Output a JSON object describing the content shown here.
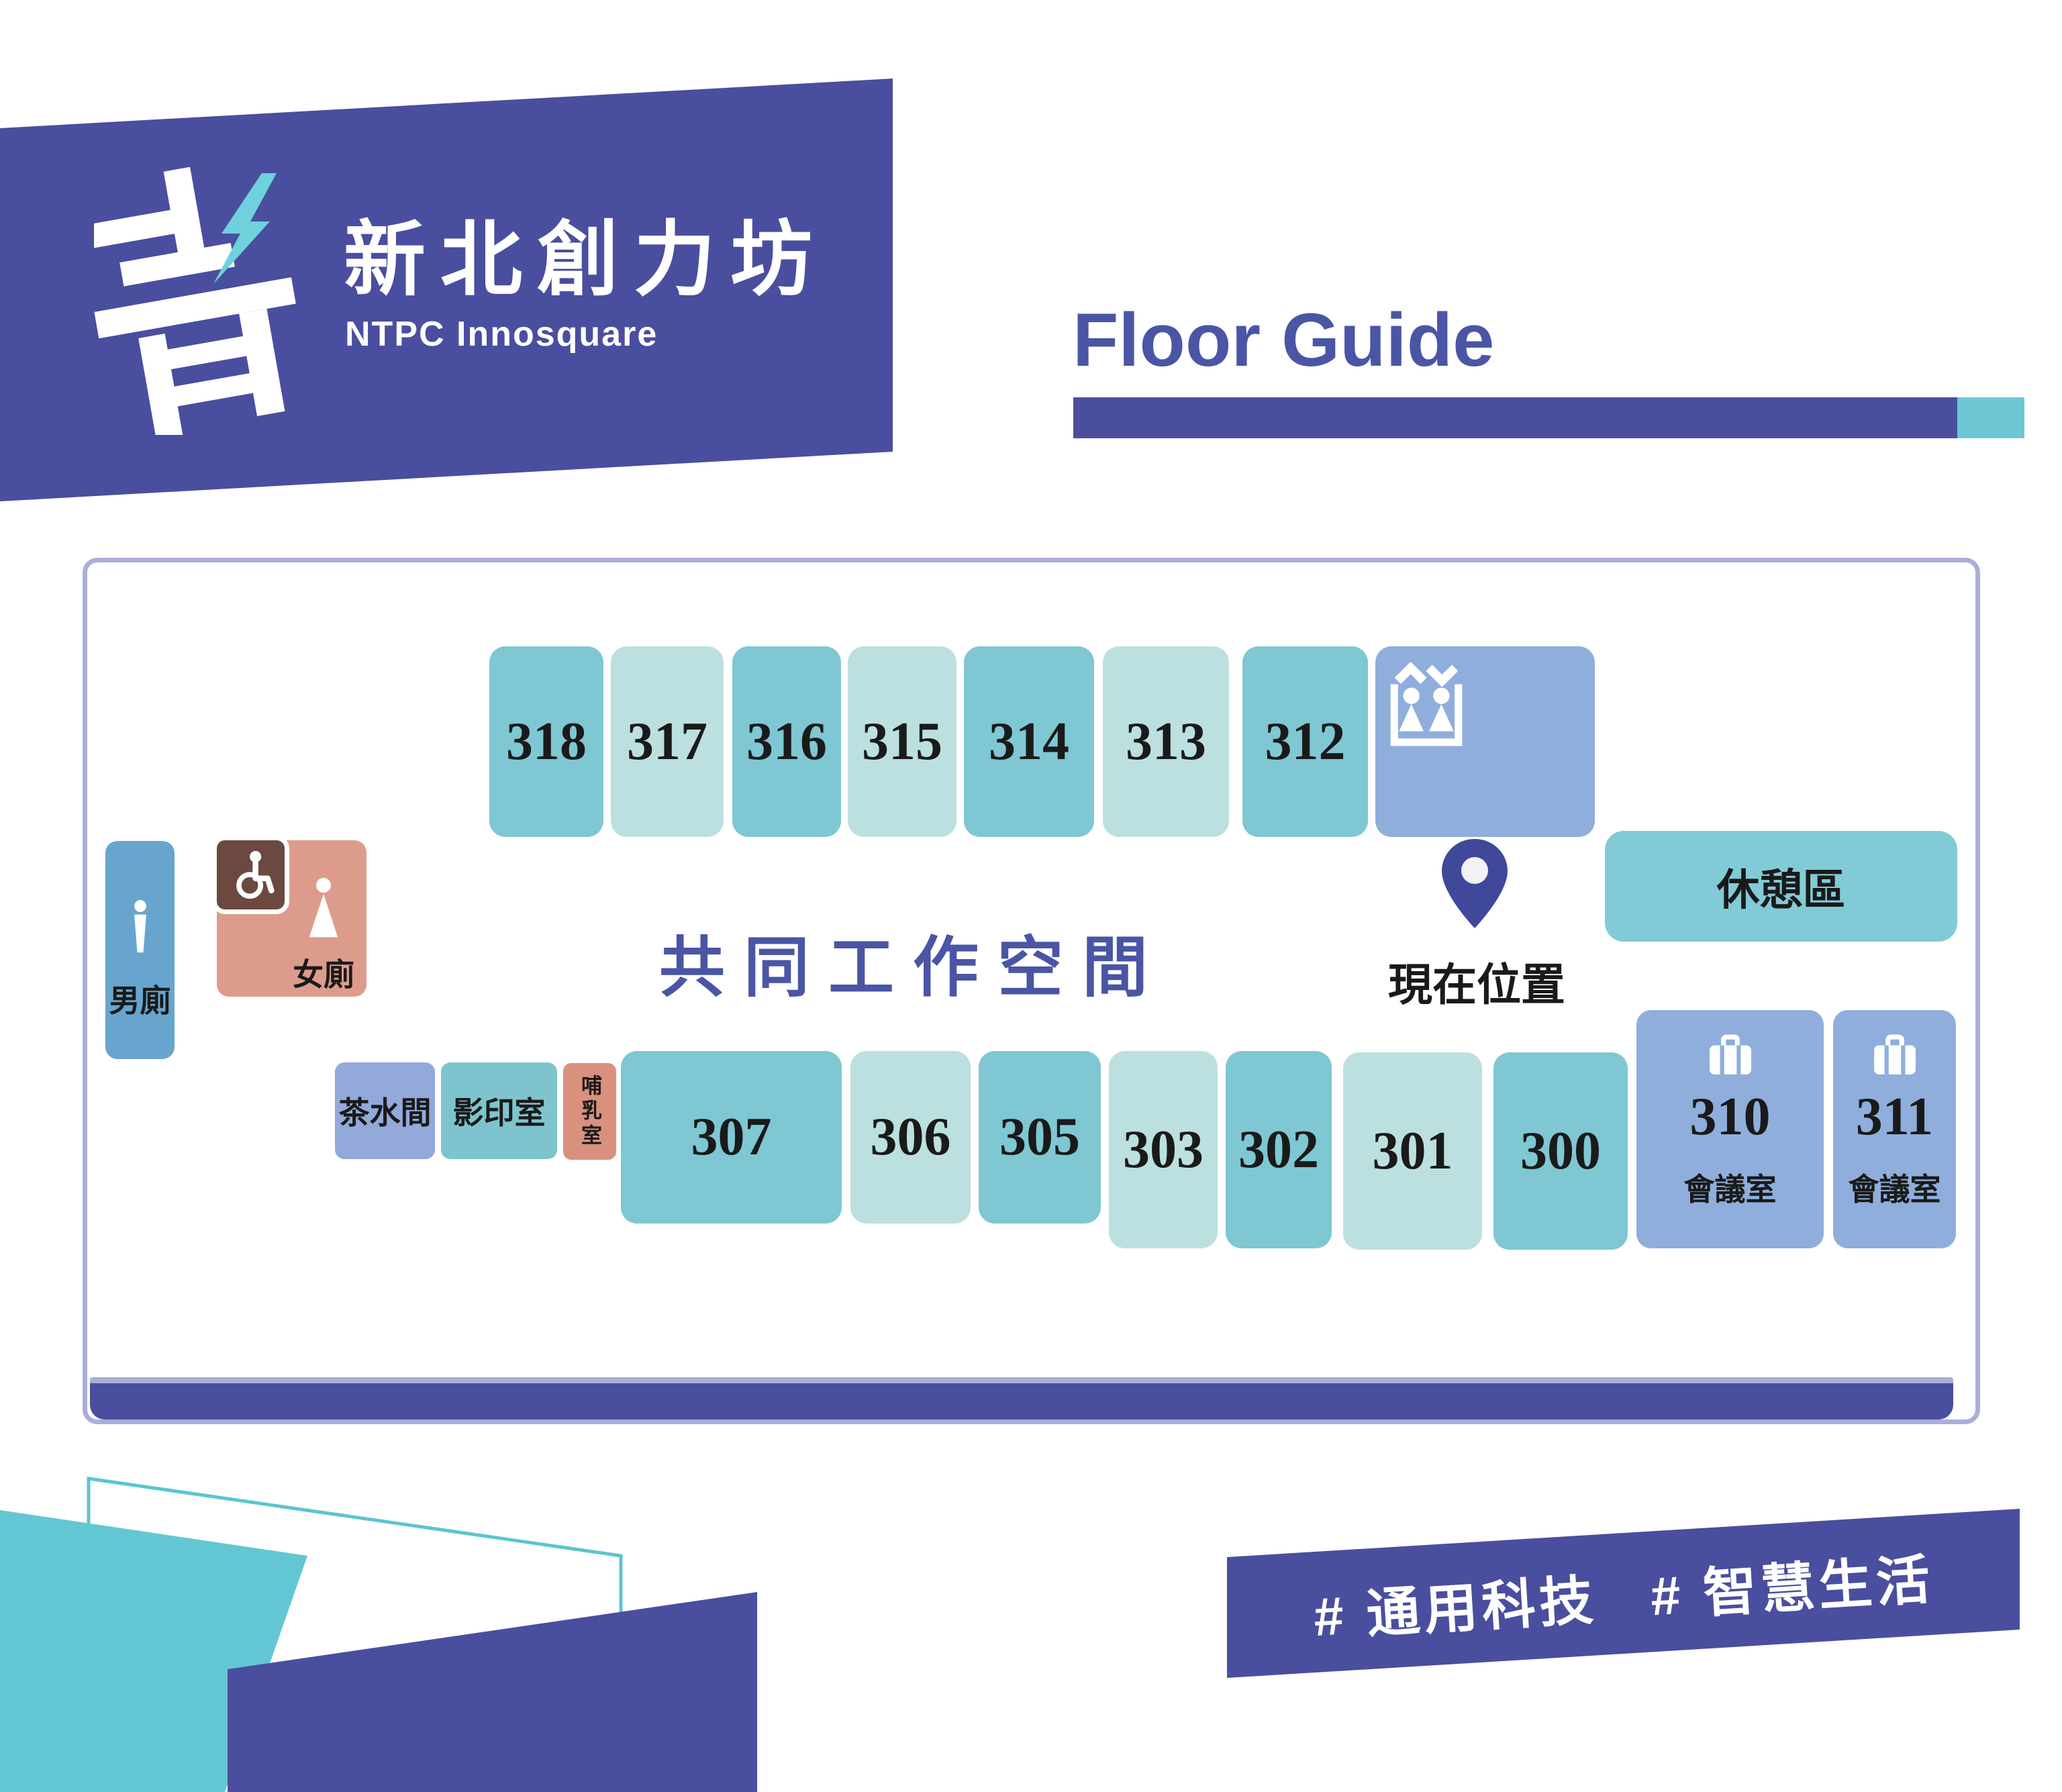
{
  "brand": {
    "title": "新北創力坊",
    "subtitle": "NTPC Innosquare",
    "logo_glyph": "青-lightning-logo"
  },
  "header": {
    "title": "Floor Guide"
  },
  "map": {
    "labels": {
      "coworking": "共同工作空間",
      "current_location": "現在位置",
      "rest_area": "休憩區",
      "male_toilet": "男廁",
      "female_toilet": "女廁",
      "tea_room": "茶水間",
      "copy_room": "影印室",
      "nursing_room": "哺乳室"
    },
    "top_rooms": [
      {
        "number": "318"
      },
      {
        "number": "317"
      },
      {
        "number": "316"
      },
      {
        "number": "315"
      },
      {
        "number": "314"
      },
      {
        "number": "313"
      },
      {
        "number": "312"
      }
    ],
    "bottom_rooms": [
      {
        "number": "307"
      },
      {
        "number": "306"
      },
      {
        "number": "305"
      },
      {
        "number": "303"
      },
      {
        "number": "302"
      },
      {
        "number": "301"
      },
      {
        "number": "300"
      }
    ],
    "meeting_rooms": [
      {
        "number": "310",
        "label": "會議室"
      },
      {
        "number": "311",
        "label": "會議室"
      }
    ]
  },
  "footer": {
    "hashtags": [
      "# 通用科技",
      "# 智慧生活"
    ]
  },
  "colors": {
    "brand_indigo": "#4A4E9E",
    "title_indigo": "#4A55A5",
    "room_teal_dark": "#7EC7D3",
    "room_teal_light": "#BCE0DF",
    "room_periwinkle": "#8FAEDC",
    "tea_room_periwinkle": "#92A9D9",
    "rest_area_teal": "#82CBD6",
    "male_blue": "#67A5CE",
    "female_salmon": "#DD9C8B",
    "nursing_salmon": "#D9907E",
    "accessible_brown": "#6B4840",
    "pin_indigo": "#3F4899",
    "map_border": "#A9AEDB",
    "accent_teal": "#63C7D3"
  }
}
